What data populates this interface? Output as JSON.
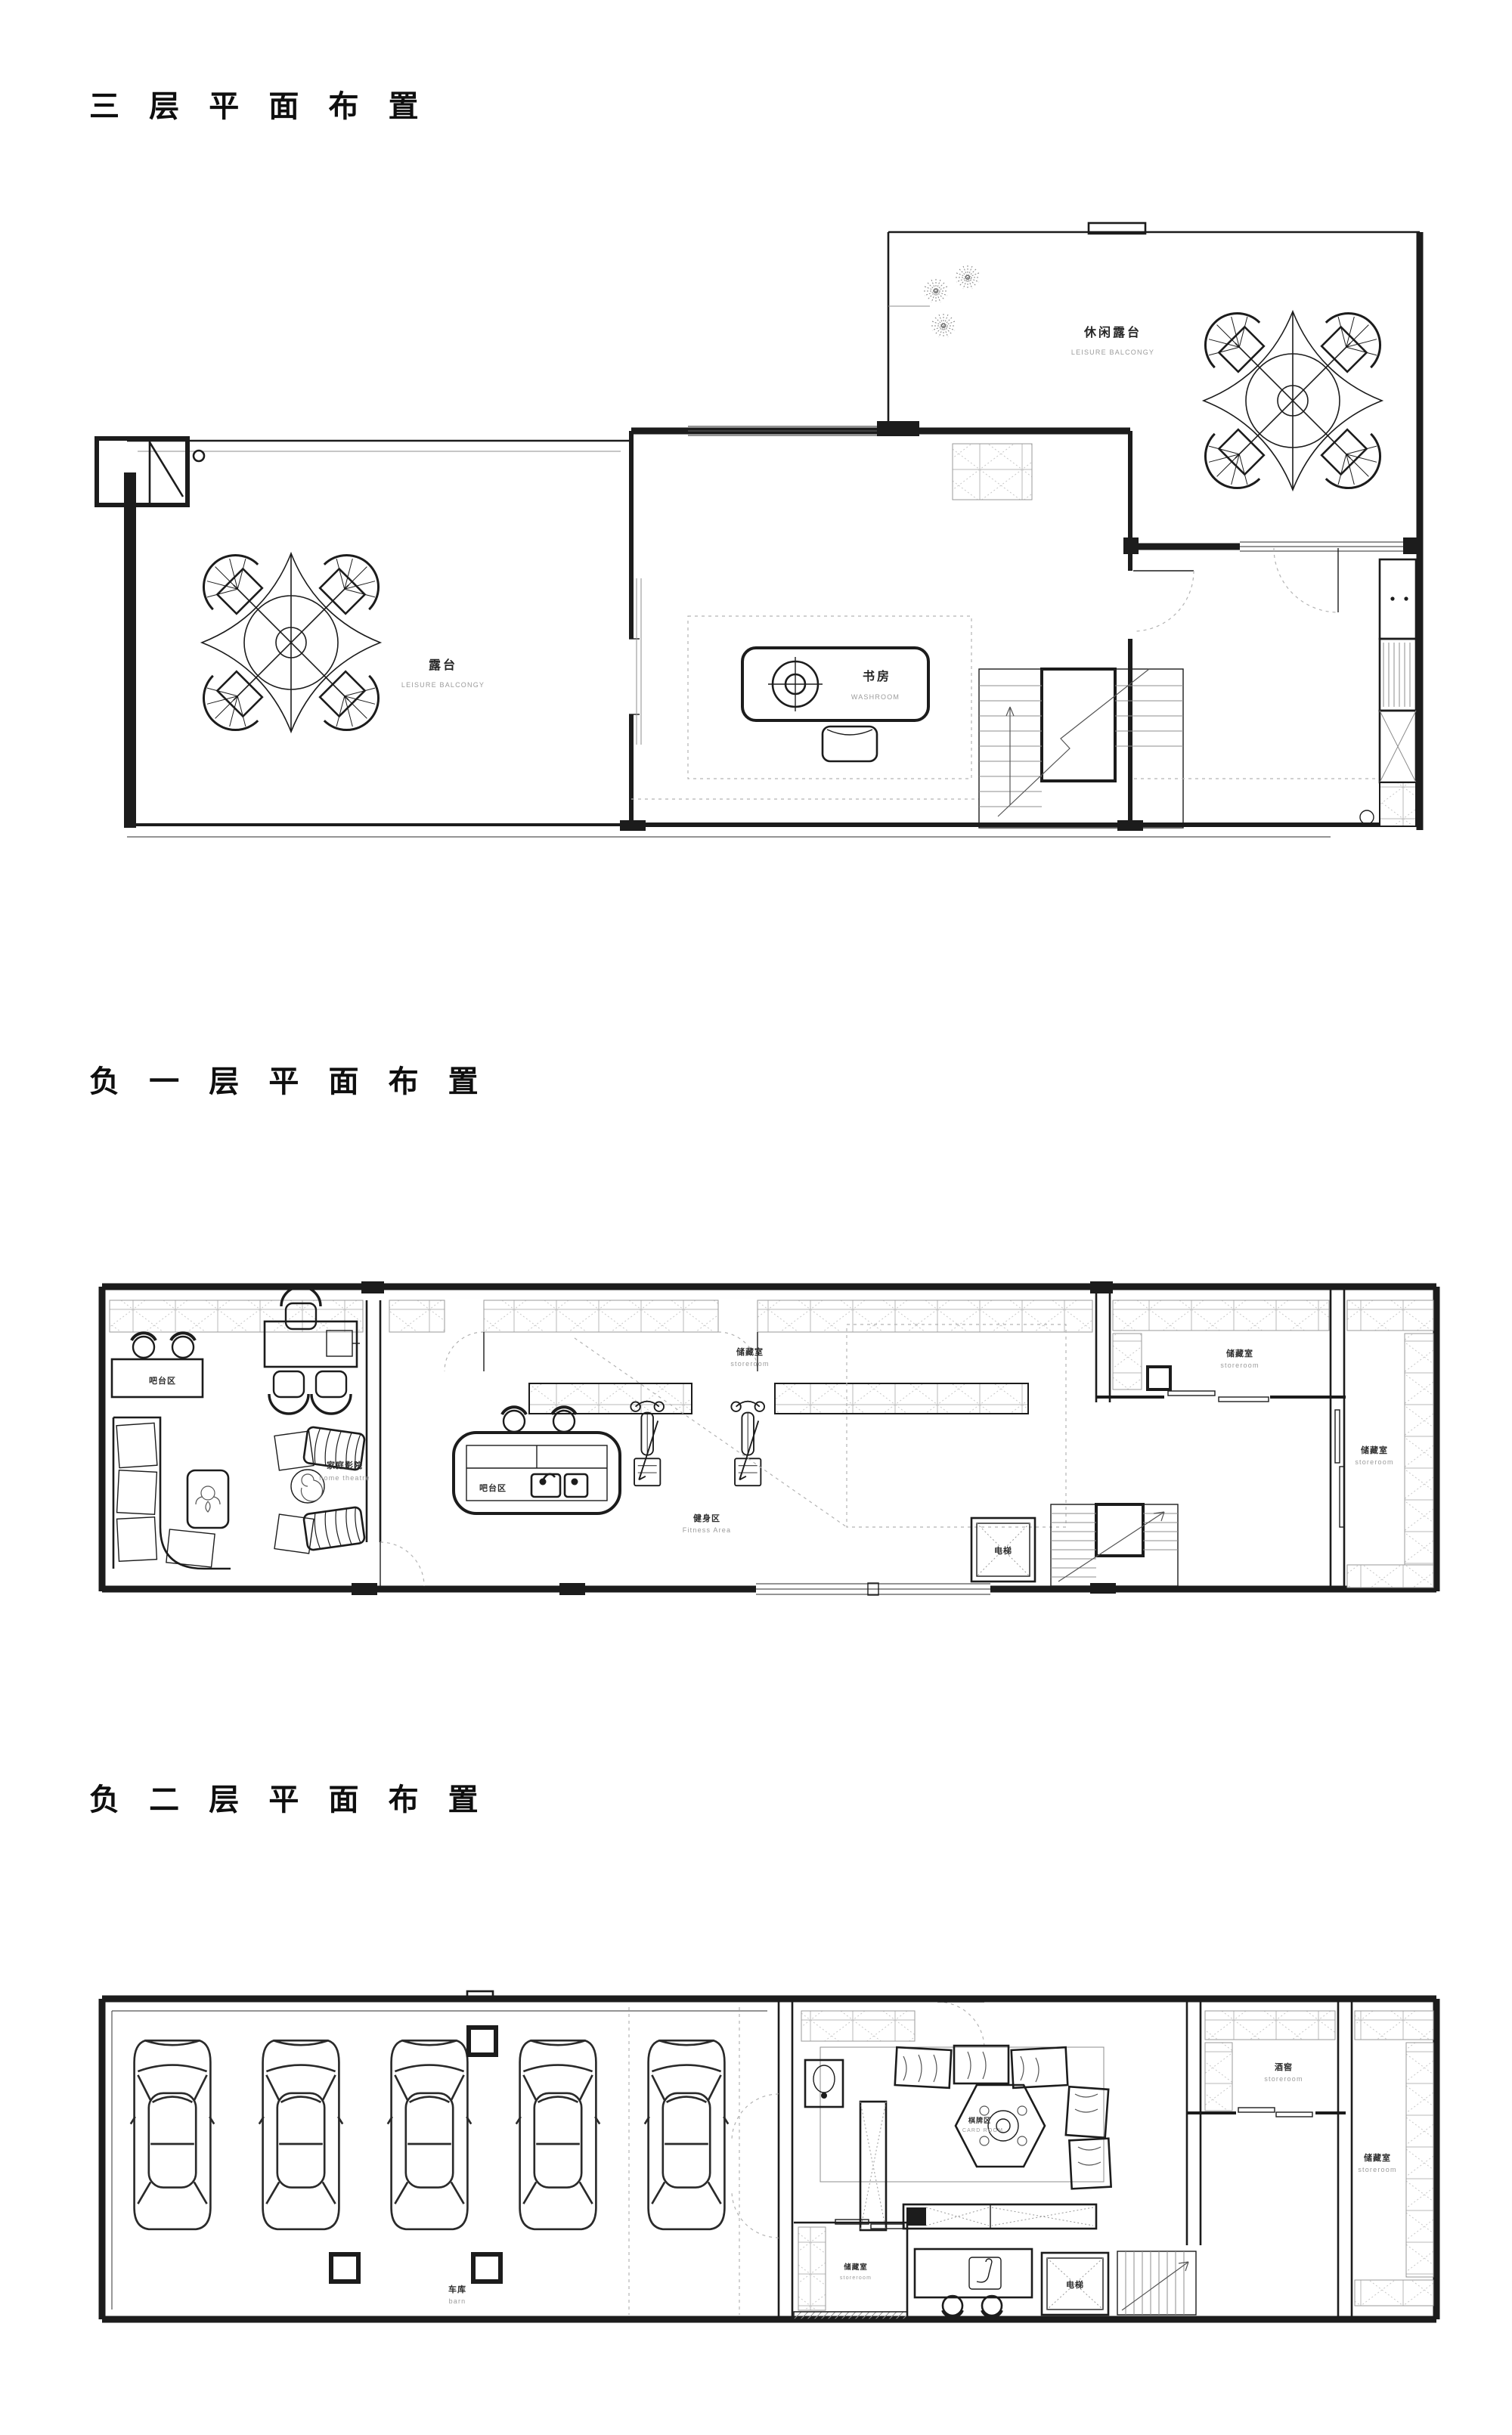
{
  "page": {
    "background": "#ffffff",
    "line_color": "#1c1c1c",
    "muted_color": "#9b9b9b"
  },
  "sections": [
    {
      "id": "floor-3",
      "title": "三 层 平 面 布 置",
      "labels": {
        "terrace": {
          "cn": "露台",
          "en": "LEISURE BALCONGY"
        },
        "leisure_balcony": {
          "cn": "休闲露台",
          "en": "LEISURE BALCONGY"
        },
        "study": {
          "cn": "书房",
          "en": "WASHROOM"
        }
      }
    },
    {
      "id": "basement-1",
      "title": "负 一 层 平 面 布 置",
      "labels": {
        "bar_counter": {
          "cn": "吧台区",
          "en": ""
        },
        "home_theatre": {
          "cn": "家庭影院",
          "en": "home theatre"
        },
        "storeroom_gym": {
          "cn": "储藏室",
          "en": "storeroom"
        },
        "bar_island": {
          "cn": "吧台区",
          "en": ""
        },
        "fitness": {
          "cn": "健身区",
          "en": "Fitness Area"
        },
        "storeroom_mid": {
          "cn": "储藏室",
          "en": "storeroom"
        },
        "storeroom_right": {
          "cn": "储藏室",
          "en": "storeroom"
        },
        "elevator": {
          "cn": "电梯",
          "en": ""
        }
      }
    },
    {
      "id": "basement-2",
      "title": "负 二 层 平 面 布 置",
      "labels": {
        "garage": {
          "cn": "车库",
          "en": "barn"
        },
        "card_room": {
          "cn": "棋牌区",
          "en": "CARD ROOM"
        },
        "wine_cellar": {
          "cn": "酒窖",
          "en": "storeroom"
        },
        "storeroom_right": {
          "cn": "储藏室",
          "en": "storeroom"
        },
        "storeroom_left": {
          "cn": "储藏室",
          "en": "storeroom"
        },
        "elevator": {
          "cn": "电梯",
          "en": ""
        }
      }
    }
  ]
}
